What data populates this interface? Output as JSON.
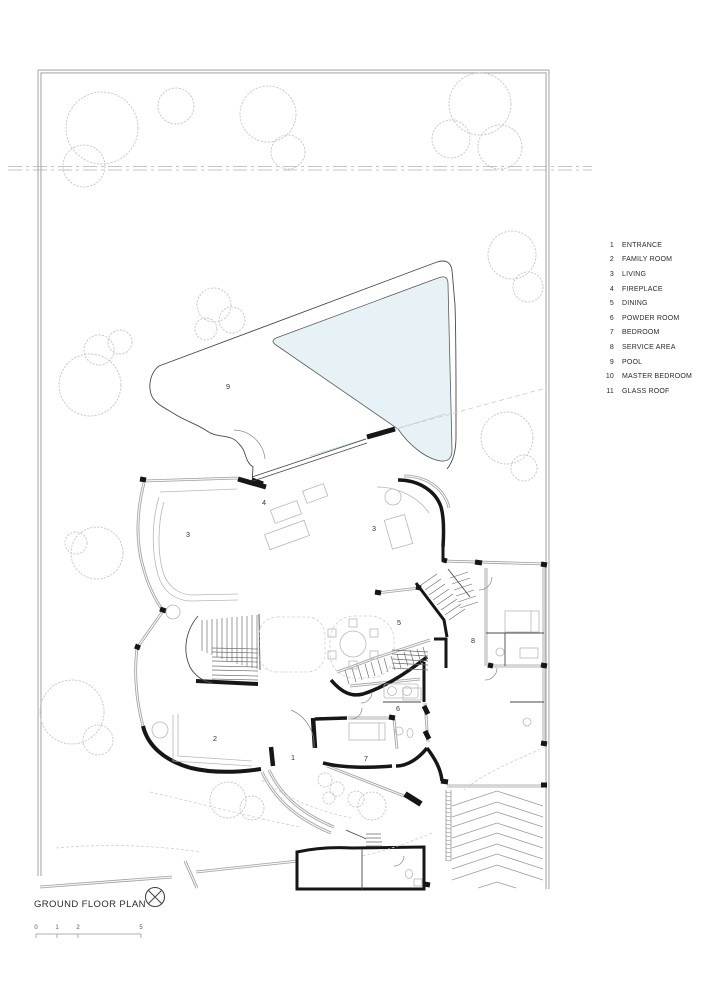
{
  "drawing": {
    "title": "GROUND FLOOR PLAN",
    "scale_ticks": [
      "0",
      "1",
      "2",
      "5"
    ],
    "legend": [
      {
        "num": "1",
        "label": "ENTRANCE"
      },
      {
        "num": "2",
        "label": "FAMILY ROOM"
      },
      {
        "num": "3",
        "label": "LIVING"
      },
      {
        "num": "4",
        "label": "FIREPLACE"
      },
      {
        "num": "5",
        "label": "DINING"
      },
      {
        "num": "6",
        "label": "POWDER ROOM"
      },
      {
        "num": "7",
        "label": "BEDROOM"
      },
      {
        "num": "8",
        "label": "SERVICE AREA"
      },
      {
        "num": "9",
        "label": "POOL"
      },
      {
        "num": "10",
        "label": "MASTER BEDROOM"
      },
      {
        "num": "11",
        "label": "GLASS ROOF"
      }
    ],
    "room_labels": [
      {
        "num": "9",
        "name": "pool"
      },
      {
        "num": "4",
        "name": "fireplace"
      },
      {
        "num": "3",
        "name": "living-left"
      },
      {
        "num": "3",
        "name": "living-right"
      },
      {
        "num": "5",
        "name": "dining"
      },
      {
        "num": "8",
        "name": "service-area"
      },
      {
        "num": "2",
        "name": "family-room"
      },
      {
        "num": "1",
        "name": "entrance"
      },
      {
        "num": "7",
        "name": "bedroom"
      },
      {
        "num": "6",
        "name": "powder-room"
      }
    ],
    "colors": {
      "pool_water": "#e6f2f5",
      "linework": "#1a1a1a",
      "boundary": "#9a9a9a"
    }
  }
}
